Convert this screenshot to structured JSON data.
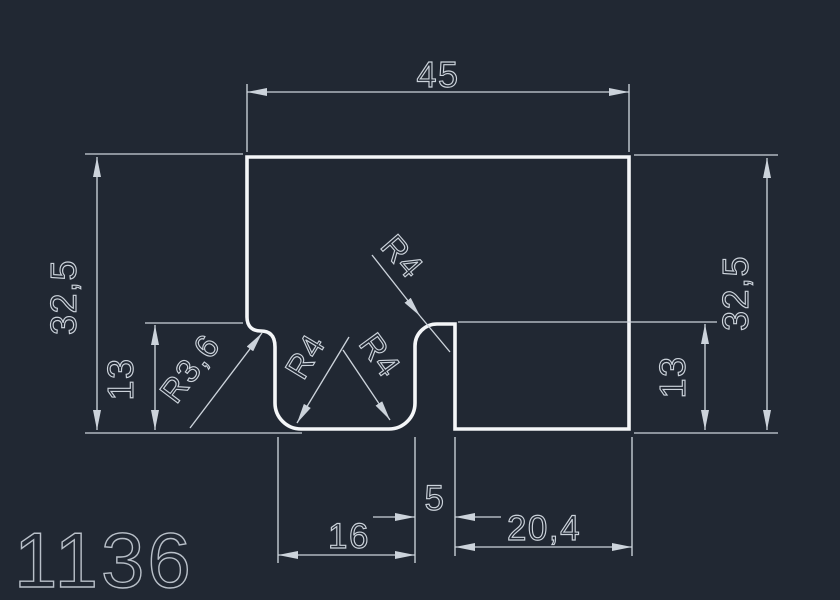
{
  "drawing": {
    "type": "cad-profile-drawing",
    "part_number": "1136",
    "colors": {
      "background": "#212833",
      "outline": "#f4f6f8",
      "dimension": "#ccd3db",
      "part_number_text": "#b9c0c9"
    },
    "dimensions": {
      "top_width": "45",
      "left_overall_height": "32,5",
      "left_step_height": "13",
      "left_fillet_radius": "R3,6",
      "tab_top_fillet_radius": "R4",
      "tab_bottom_left_fillet_radius": "R4",
      "tab_bottom_right_fillet_radius": "R4",
      "slot_width": "5",
      "tab_width": "16",
      "right_width": "20,4",
      "right_overall_height": "32,5",
      "right_step_height": "13"
    }
  }
}
